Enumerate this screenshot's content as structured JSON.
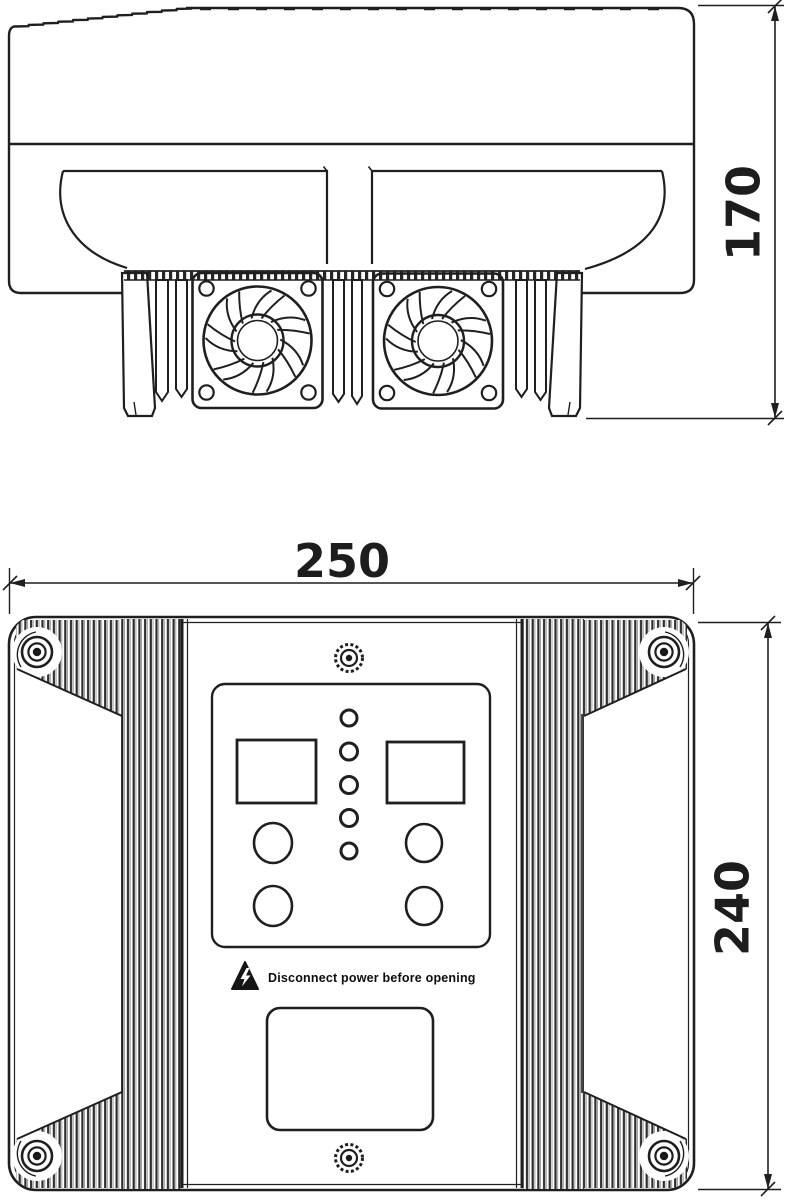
{
  "drawing": {
    "colors": {
      "ink": "#1f1f1f",
      "background": "#ffffff"
    },
    "side_view": {
      "height_dimension_label": "170"
    },
    "front_view": {
      "width_dimension_label": "250",
      "height_dimension_label": "240",
      "warning_text": "Disconnect power before opening"
    }
  }
}
